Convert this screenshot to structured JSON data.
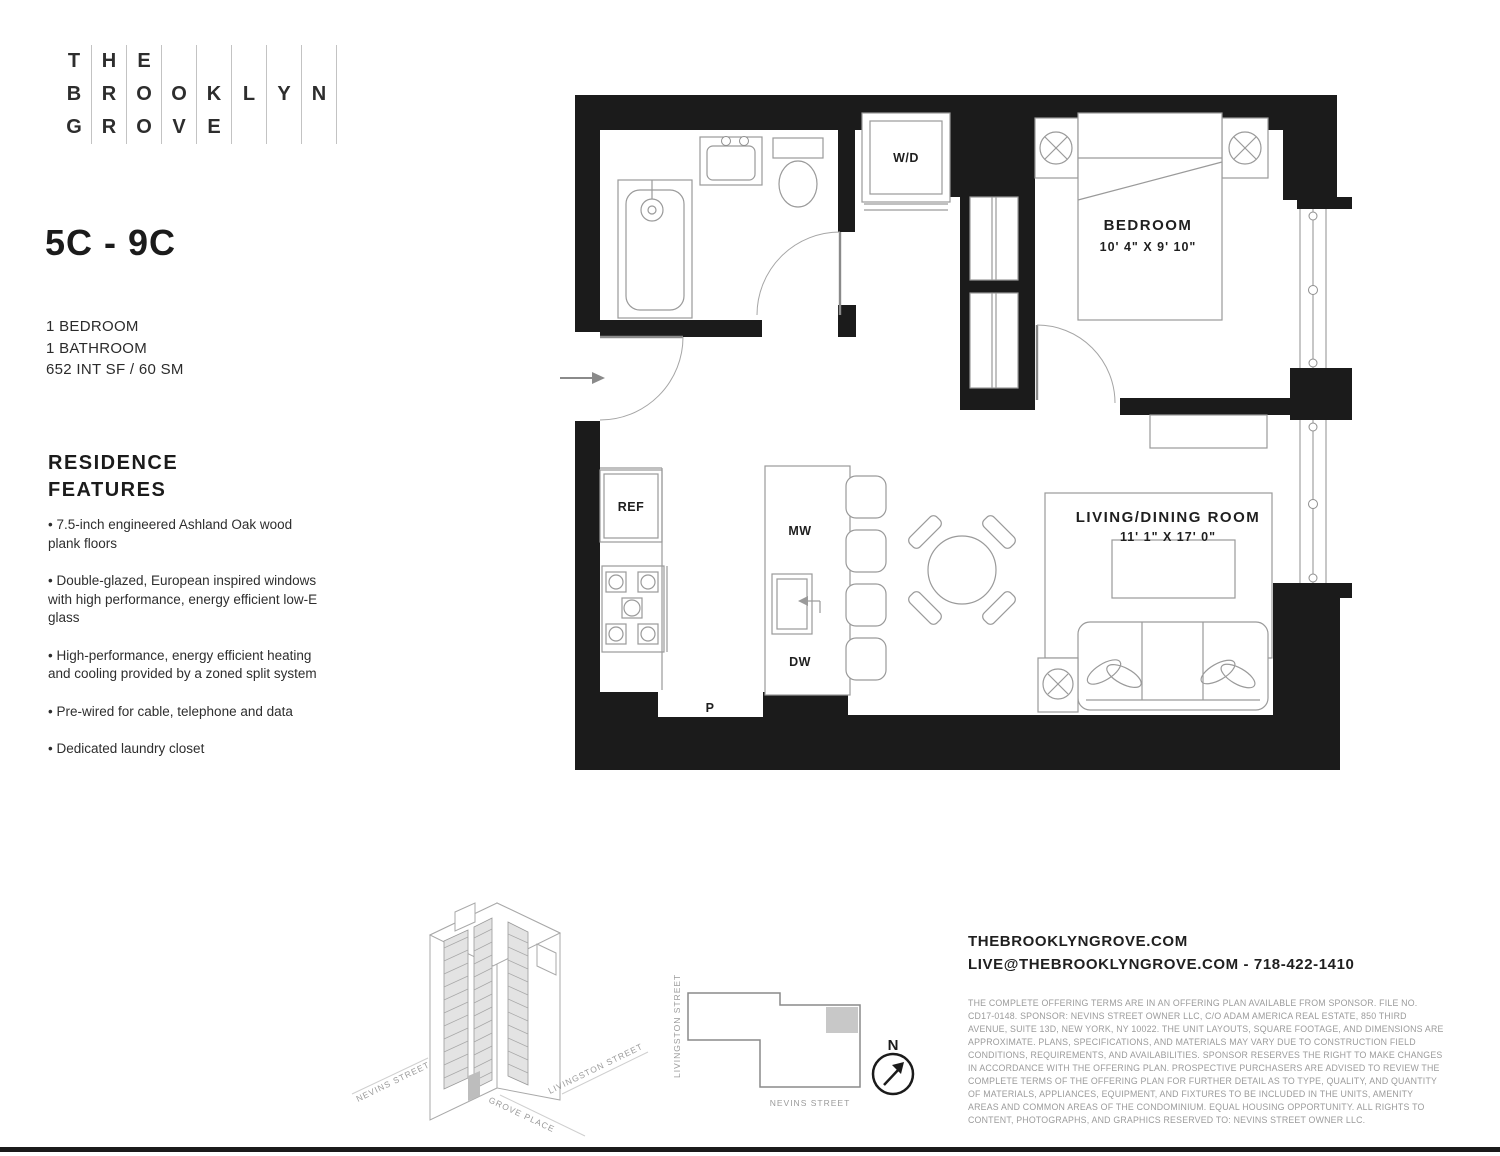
{
  "logo": {
    "grid": [
      [
        "T",
        "B",
        "G"
      ],
      [
        "H",
        "R",
        "R"
      ],
      [
        "E",
        "O",
        "O"
      ],
      [
        "",
        "O",
        "V"
      ],
      [
        "",
        "K",
        "E"
      ],
      [
        "",
        "L",
        ""
      ],
      [
        "",
        "Y",
        ""
      ],
      [
        "",
        "N",
        ""
      ]
    ]
  },
  "unit": {
    "title": "5C - 9C",
    "specs": [
      "1 BEDROOM",
      "1 BATHROOM",
      "652 INT SF / 60 SM"
    ]
  },
  "features": {
    "heading": "RESIDENCE FEATURES",
    "items": [
      "7.5-inch engineered Ashland Oak wood plank floors",
      "Double-glazed, European inspired windows with high performance, energy efficient low-E glass",
      "High-performance, energy efficient heating and cooling provided by a zoned split system",
      "Pre-wired for cable, telephone and data",
      "Dedicated laundry closet"
    ]
  },
  "plan": {
    "bedroom": {
      "name": "BEDROOM",
      "dims": "10' 4\" X 9' 10\""
    },
    "living": {
      "name": "LIVING/DINING ROOM",
      "dims": "11' 1\" X 17' 0\""
    },
    "labels": {
      "wd": "W/D",
      "ref": "REF",
      "mw": "MW",
      "dw": "DW",
      "p": "P"
    }
  },
  "axon": {
    "streets": {
      "nevins": "NEVINS STREET",
      "grove": "GROVE PLACE",
      "livingston": "LIVINGSTON STREET"
    }
  },
  "site": {
    "streets": {
      "livingston": "LIVINGSTON STREET",
      "nevins": "NEVINS STREET"
    },
    "north": "N"
  },
  "contact": {
    "website": "THEBROOKLYNGROVE.COM",
    "email_phone": "LIVE@THEBROOKLYNGROVE.COM - 718-422-1410"
  },
  "legal": {
    "disclaimer": "THE COMPLETE OFFERING TERMS ARE IN AN OFFERING PLAN AVAILABLE FROM SPONSOR. FILE NO. CD17-0148. SPONSOR: NEVINS STREET OWNER LLC, C/O ADAM AMERICA REAL ESTATE, 850 THIRD AVENUE, SUITE 13D, NEW YORK, NY 10022. THE UNIT LAYOUTS, SQUARE FOOTAGE, AND DIMENSIONS ARE APPROXIMATE. PLANS, SPECIFICATIONS, AND MATERIALS MAY VARY DUE TO CONSTRUCTION FIELD CONDITIONS, REQUIREMENTS, AND AVAILABILITIES. SPONSOR RESERVES THE RIGHT TO MAKE CHANGES IN ACCORDANCE WITH THE OFFERING PLAN. PROSPECTIVE PURCHASERS ARE ADVISED TO REVIEW THE COMPLETE TERMS OF THE OFFERING PLAN FOR FURTHER DETAIL AS TO TYPE, QUALITY, AND QUANTITY OF MATERIALS, APPLIANCES, EQUIPMENT, AND FIXTURES TO BE INCLUDED IN THE UNITS, AMENITY AREAS AND COMMON AREAS OF THE CONDOMINIUM. EQUAL HOUSING OPPORTUNITY. ALL RIGHTS TO CONTENT, PHOTOGRAPHS, AND GRAPHICS RESERVED TO: NEVINS STREET OWNER LLC."
  },
  "colors": {
    "wall": "#1b1b1b",
    "furniture_line": "#9a9a9a",
    "site_highlight": "#c8c8c8",
    "muted_text": "#9b9b9b"
  }
}
